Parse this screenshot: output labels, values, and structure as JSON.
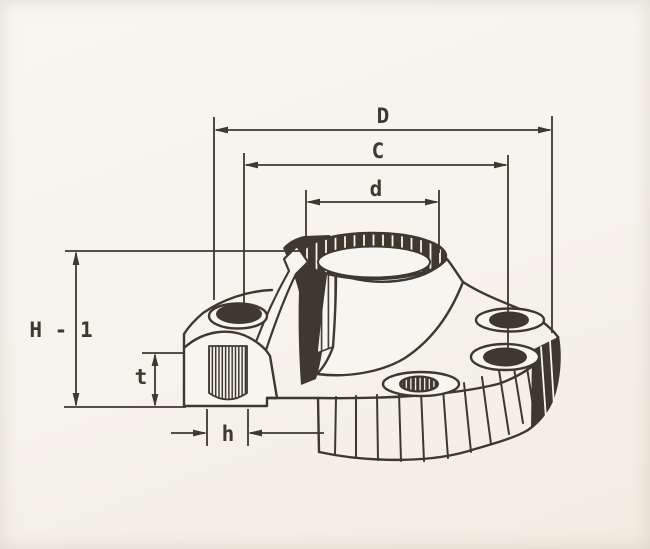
{
  "diagram": {
    "type": "technical-drawing",
    "subject": "weld-neck-flange-isometric-cutaway",
    "colors": {
      "ink": "#3e382f",
      "paper": "#f6f3ec"
    },
    "dimensions": [
      {
        "id": "D",
        "label": "D"
      },
      {
        "id": "C",
        "label": "C"
      },
      {
        "id": "d",
        "label": "d"
      },
      {
        "id": "H1",
        "label": "H - 1"
      },
      {
        "id": "t",
        "label": "t"
      },
      {
        "id": "h",
        "label": "h"
      }
    ]
  }
}
